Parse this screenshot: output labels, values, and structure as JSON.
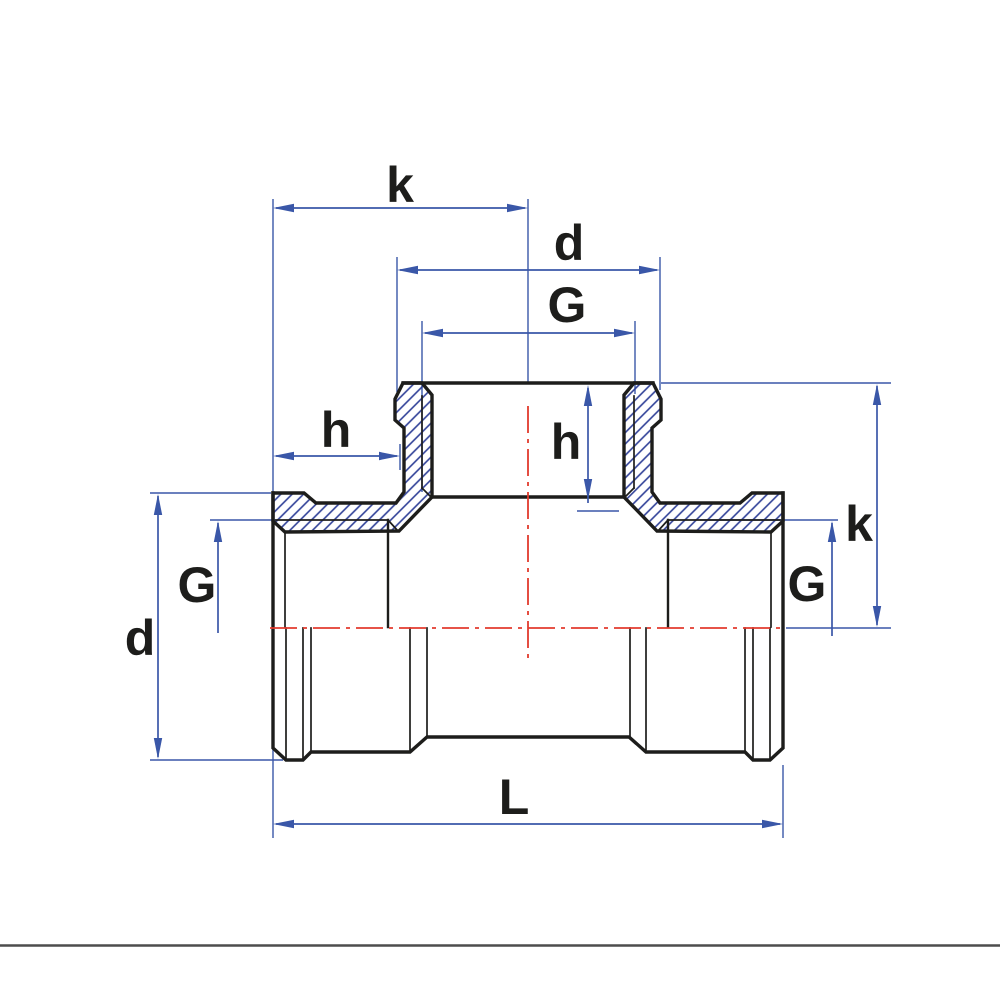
{
  "drawing": {
    "dimension_labels": {
      "k_top": "k",
      "d_top": "d",
      "g_top": "G",
      "h_left": "h",
      "h_branch": "h",
      "k_right": "k",
      "g_right": "G",
      "g_left": "G",
      "d_left": "d",
      "l_bottom": "L"
    },
    "colors": {
      "outline_black": "#1d1d1b",
      "dimension_blue": "#3a57a8",
      "hatch_blue": "#2e3f97",
      "centerline_red": "#e23b2e",
      "divider_gray": "#4d4d4d",
      "background": "#ffffff"
    }
  }
}
